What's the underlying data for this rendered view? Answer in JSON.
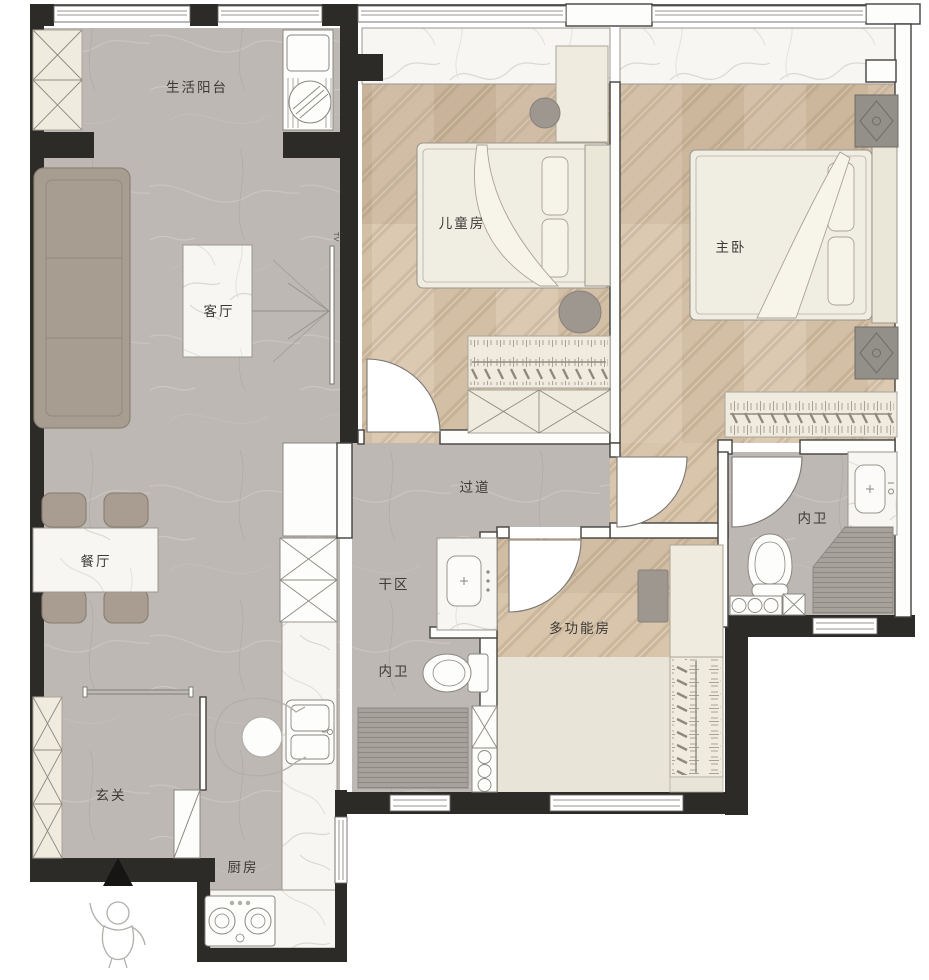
{
  "floorplan": {
    "rooms": {
      "balcony": {
        "label": "生活阳台"
      },
      "living": {
        "label": "客厅"
      },
      "dining": {
        "label": "餐厅"
      },
      "entry": {
        "label": "玄关"
      },
      "kitchen": {
        "label": "厨房"
      },
      "kids_bedroom": {
        "label": "儿童房"
      },
      "master_bedroom": {
        "label": "主卧"
      },
      "corridor": {
        "label": "过道"
      },
      "dry_area": {
        "label": "干区"
      },
      "bath_inner_left": {
        "label": "内卫"
      },
      "bath_inner_right": {
        "label": "内卫"
      },
      "multifunction": {
        "label": "多功能房"
      }
    },
    "annotations": {
      "tv": "TV"
    },
    "colors": {
      "exterior_wall": "#2d2b28",
      "tile_floor": "#bdb8b3",
      "wood_floor": "#d8c5ac",
      "marble": "#f7f6f3",
      "cream_furniture": "#efecdf",
      "sofa": "#a79d91",
      "grey_furniture": "#9d9790"
    },
    "symbols": [
      "door-swing",
      "window",
      "wardrobe-hangers",
      "bed",
      "sofa",
      "dining-set",
      "toilet",
      "shower",
      "sink",
      "washing-machine",
      "stove",
      "entry-arrow",
      "person-figure",
      "tv"
    ]
  }
}
